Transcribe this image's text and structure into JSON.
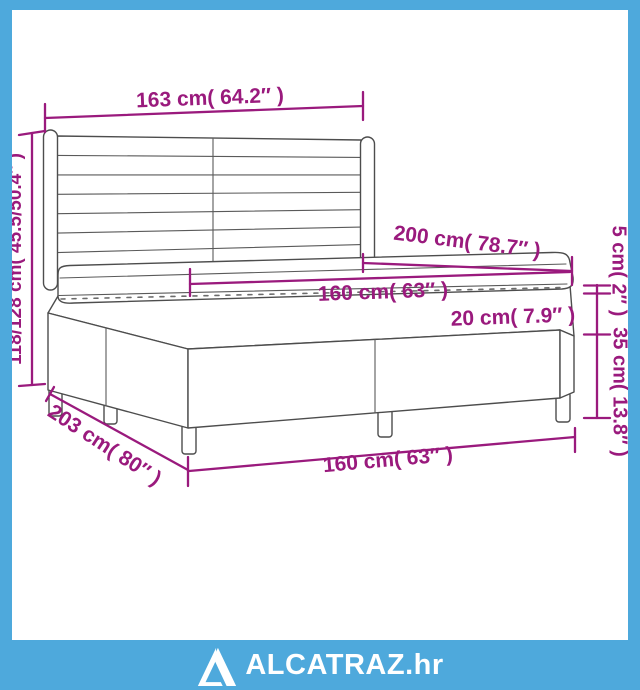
{
  "frame": {
    "border_color": "#4ea9dc",
    "background_color": "#ffffff"
  },
  "diagram": {
    "subject": "box spring bed with headboard and mattress",
    "outline_color": "#4d4d4d",
    "dimension_color": "#9a1a7d",
    "dimensions": {
      "headboard_width": "163 cm( 64.2″ )",
      "total_height": "118/128 cm( 45.5/50.4″ )",
      "bed_length": "200 cm( 78.7″ )",
      "mattress_width": "160 cm( 63″ )",
      "mattress_thickness": "20 cm( 7.9″ )",
      "topper_thickness": "5 cm( 2″ )",
      "base_height": "35 cm( 13.8″ )",
      "base_length": "203 cm( 80″ )",
      "base_width": "160 cm( 63″ )"
    }
  },
  "footer": {
    "brand": "ALCATRAZ.hr",
    "bar_color": "#4ea9dc",
    "text_color": "#ffffff"
  }
}
